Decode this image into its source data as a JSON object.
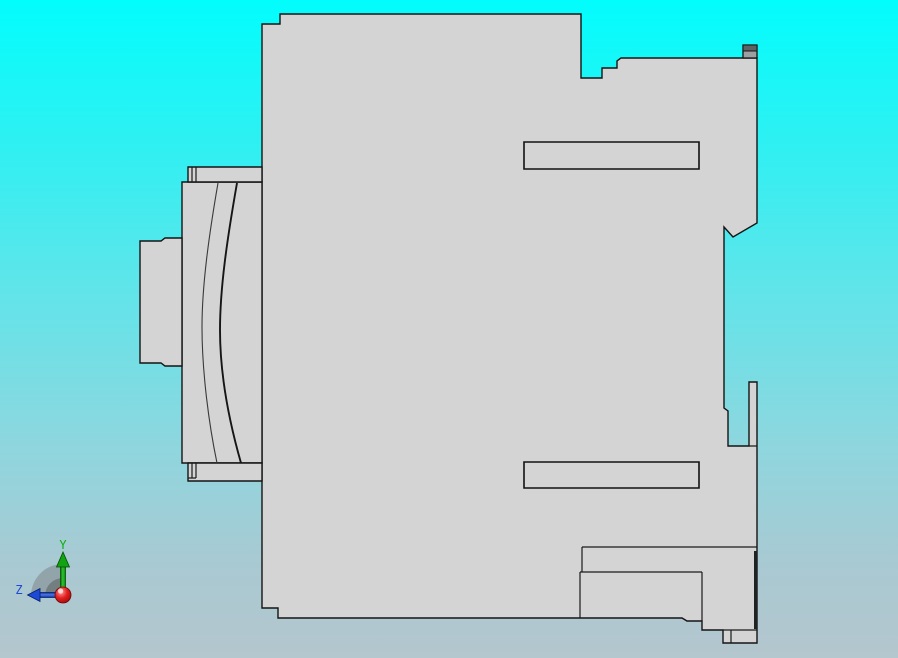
{
  "scene": {
    "description": "CAD viewport - side profile view of a contactor / circuit-breaker style part with DIN-rail mount profile",
    "colors": {
      "background_top": "#02fdfd",
      "background_bottom": "#b4c6ce",
      "part_fill": "#d4d4d4",
      "edge": "#141414",
      "clip_dark_band": "#5e6466",
      "clip_light_band": "#9ba1a3",
      "axis_y_green": "#0caf0c",
      "axis_z_blue": "#1c49d6",
      "origin_red": "#d31515"
    }
  },
  "part": {
    "silhouette": "M262,24 L280,24 L280,14 L581,14 L581,78 L602,78 L602,68 L617,68 L617,61 L621,58 L757,58 L757,223 L733,237 L724,227 L724,408 L728,411 L728,446 L749,446 L749,382 L757,382 L757,643 L723,643 L723,630 L702,630 L702,621 L687,621 L682,618 L278,618 L278,608 L262,608 Z",
    "coil_block": "M182,182 L262,182 L262,463 L182,463 Z",
    "coil_top_bar": "M188,167 L262,167 L262,182 L188,182 Z",
    "coil_bottom_bar": "M188,463 L262,463 L262,481 L188,481 Z",
    "mount_flange": "M140,241 L161,241 L165,238 L182,238 L182,366 L165,366 L161,363 L140,363 Z",
    "bar_strip_lines": "M192,167 L192,182 M196,167 L196,182 M192,463 L192,478 M196,463 L196,478 M188,478 L196,478",
    "bobbin_curve_left": "M218,183 C209,235 202,285 202,327 C202,372 209,425 217,463",
    "bobbin_curve_right": "M237,183 C227,240 220,288 220,330 C220,378 231,428 241,463",
    "slot_upper": "M524,142 L699,142 L699,169 L524,169 Z",
    "slot_lower": "M524,462 L699,462 L699,488 L524,488 Z",
    "detail_lines": "M582,547 L757,547 M582,547 L582,572 M580,572 L702,572 M580,572 L580,618 M702,572 L702,621 M723,630 L757,630 M731,630 L731,643 M749,446 L757,446",
    "right_edge_shade": "M755.5,551 L755.5,629",
    "din_clip_body": "M743,45 L757,45 L757,58 L743,58 Z",
    "din_clip_band": "M743,45 L757,45 L757,51 L743,51 Z"
  },
  "triad": {
    "labels": {
      "y": "Y",
      "z": "Z"
    },
    "shadow_outer": "M63,596 L63,564 A32,32 0 0 0 31,596 Z",
    "shadow_inner": "M63,596 L63,578 A18,18 0 0 0 45,596 Z",
    "y_shaft": "M60.5,565 L65.5,565 L65.5,589 L60.5,589 Z",
    "y_head": "M63,552 L56.5,567 L69.5,567 Z",
    "z_shaft": "M40,592.5 L60,592.5 L60,597.5 L40,597.5 Z",
    "z_head": "M27.5,595 L40,588.5 L40,601.5 Z",
    "origin": "M55,595 A8,8 0 1 0 71,595 A8,8 0 1 0 55,595 Z",
    "origin_highlight": "M58,591 A2.6,2.6 0 1 0 63.2,591 A2.6,2.6 0 1 0 58,591 Z"
  }
}
